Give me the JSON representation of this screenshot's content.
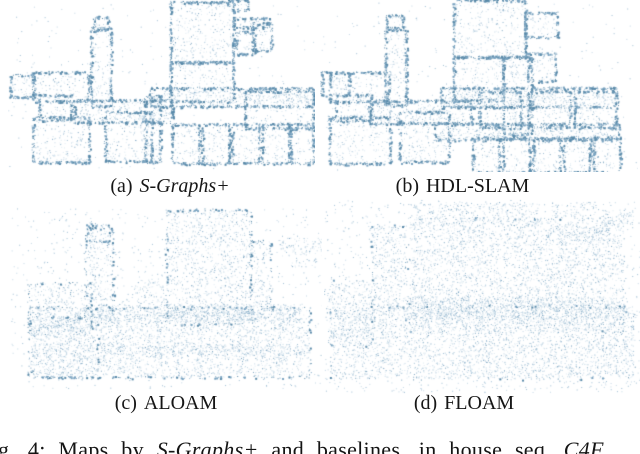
{
  "figure": {
    "panels": [
      {
        "id": "a",
        "label": "(a)",
        "method": "S-Graphs+",
        "method_italic": true,
        "box": {
          "left": 8,
          "top": 0,
          "width": 307,
          "height": 172
        },
        "caption_box": {
          "left": 10,
          "top": 174,
          "width": 320
        },
        "style": {
          "fill": 0.07,
          "edge": 1.0,
          "scatter": 0.004,
          "seed": 101
        },
        "shapes": [
          {
            "x": 0.528,
            "y": 0.012,
            "w": 0.205,
            "h": 0.35,
            "e": 1.1
          },
          {
            "x": 0.733,
            "y": 0.105,
            "w": 0.114,
            "h": 0.052,
            "e": 1
          },
          {
            "x": 0.743,
            "y": 0.186,
            "w": 0.059,
            "h": 0.128,
            "e": 1
          },
          {
            "x": 0.795,
            "y": 0.134,
            "w": 0.062,
            "h": 0.157,
            "e": 1
          },
          {
            "x": 0.717,
            "y": 0.0,
            "w": 0.065,
            "h": 0.058,
            "e": 1
          },
          {
            "x": 0.27,
            "y": 0.163,
            "w": 0.065,
            "h": 0.453,
            "e": 1
          },
          {
            "x": 0.28,
            "y": 0.099,
            "w": 0.046,
            "h": 0.076,
            "e": 1
          },
          {
            "x": 0.007,
            "y": 0.436,
            "w": 0.078,
            "h": 0.128,
            "e": 1
          },
          {
            "x": 0.081,
            "y": 0.419,
            "w": 0.179,
            "h": 0.169,
            "e": 1
          },
          {
            "x": 0.101,
            "y": 0.552,
            "w": 0.104,
            "h": 0.145,
            "e": 1
          },
          {
            "x": 0.081,
            "y": 0.68,
            "w": 0.182,
            "h": 0.262,
            "e": 1
          },
          {
            "x": 0.215,
            "y": 0.581,
            "w": 0.319,
            "h": 0.128,
            "e": 1,
            "f": 1.6
          },
          {
            "x": 0.316,
            "y": 0.651,
            "w": 0.15,
            "h": 0.285,
            "e": 1
          },
          {
            "x": 0.528,
            "y": 0.36,
            "w": 0.205,
            "h": 0.227,
            "e": 1
          },
          {
            "x": 0.463,
            "y": 0.512,
            "w": 0.531,
            "h": 0.105,
            "e": 1,
            "f": 1.8
          },
          {
            "x": 0.772,
            "y": 0.529,
            "w": 0.222,
            "h": 0.215,
            "e": 1
          },
          {
            "x": 0.446,
            "y": 0.558,
            "w": 0.049,
            "h": 0.384,
            "e": 1,
            "f": 1.2
          },
          {
            "x": 0.534,
            "y": 0.721,
            "w": 0.088,
            "h": 0.227,
            "e": 1
          },
          {
            "x": 0.632,
            "y": 0.721,
            "w": 0.088,
            "h": 0.227,
            "e": 1
          },
          {
            "x": 0.73,
            "y": 0.721,
            "w": 0.088,
            "h": 0.227,
            "e": 1
          },
          {
            "x": 0.827,
            "y": 0.721,
            "w": 0.088,
            "h": 0.227,
            "e": 1
          },
          {
            "x": 0.921,
            "y": 0.721,
            "w": 0.073,
            "h": 0.227,
            "e": 1
          }
        ]
      },
      {
        "id": "b",
        "label": "(b)",
        "method": "HDL-SLAM",
        "method_italic": false,
        "box": {
          "left": 320,
          "top": 0,
          "width": 318,
          "height": 172
        },
        "caption_box": {
          "left": 320,
          "top": 174,
          "width": 285
        },
        "style": {
          "fill": 0.07,
          "edge": 1.0,
          "scatter": 0.004,
          "seed": 202
        },
        "shapes": [
          {
            "x": 0.42,
            "y": 0.0,
            "w": 0.225,
            "h": 0.33,
            "e": 1.1
          },
          {
            "x": 0.645,
            "y": 0.075,
            "w": 0.1,
            "h": 0.14,
            "e": 1
          },
          {
            "x": 0.655,
            "y": 0.31,
            "w": 0.085,
            "h": 0.16,
            "e": 1
          },
          {
            "x": 0.575,
            "y": 0.33,
            "w": 0.09,
            "h": 0.45,
            "e": 1,
            "f": 1.3
          },
          {
            "x": 0.205,
            "y": 0.16,
            "w": 0.065,
            "h": 0.45,
            "e": 1
          },
          {
            "x": 0.21,
            "y": 0.09,
            "w": 0.05,
            "h": 0.08,
            "e": 1
          },
          {
            "x": 0.005,
            "y": 0.42,
            "w": 0.085,
            "h": 0.13,
            "e": 1
          },
          {
            "x": 0.03,
            "y": 0.42,
            "w": 0.185,
            "h": 0.17,
            "e": 1
          },
          {
            "x": 0.05,
            "y": 0.55,
            "w": 0.11,
            "h": 0.15,
            "e": 1
          },
          {
            "x": 0.03,
            "y": 0.68,
            "w": 0.19,
            "h": 0.27,
            "e": 1
          },
          {
            "x": 0.155,
            "y": 0.585,
            "w": 0.32,
            "h": 0.13,
            "e": 1,
            "f": 1.6
          },
          {
            "x": 0.25,
            "y": 0.65,
            "w": 0.155,
            "h": 0.29,
            "e": 1
          },
          {
            "x": 0.42,
            "y": 0.33,
            "w": 0.155,
            "h": 0.25,
            "e": 1
          },
          {
            "x": 0.38,
            "y": 0.51,
            "w": 0.555,
            "h": 0.11,
            "e": 1,
            "f": 1.7
          },
          {
            "x": 0.5,
            "y": 0.53,
            "w": 0.13,
            "h": 0.21,
            "e": 1
          },
          {
            "x": 0.655,
            "y": 0.53,
            "w": 0.13,
            "h": 0.21,
            "e": 1
          },
          {
            "x": 0.8,
            "y": 0.53,
            "w": 0.13,
            "h": 0.21,
            "e": 1
          },
          {
            "x": 0.36,
            "y": 0.72,
            "w": 0.58,
            "h": 0.09,
            "e": 1,
            "f": 1.9
          },
          {
            "x": 0.48,
            "y": 0.8,
            "w": 0.083,
            "h": 0.2,
            "e": 1
          },
          {
            "x": 0.575,
            "y": 0.8,
            "w": 0.083,
            "h": 0.2,
            "e": 1
          },
          {
            "x": 0.67,
            "y": 0.8,
            "w": 0.083,
            "h": 0.2,
            "e": 1
          },
          {
            "x": 0.765,
            "y": 0.8,
            "w": 0.083,
            "h": 0.2,
            "e": 1
          },
          {
            "x": 0.86,
            "y": 0.8,
            "w": 0.083,
            "h": 0.2,
            "e": 1
          }
        ]
      },
      {
        "id": "c",
        "label": "(c)",
        "method": "ALOAM",
        "method_italic": false,
        "box": {
          "left": 10,
          "top": 206,
          "width": 312,
          "height": 184
        },
        "caption_box": {
          "left": 10,
          "top": 391,
          "width": 312
        },
        "style": {
          "fill": 0.1,
          "edge": 0.55,
          "scatter": 0.013,
          "seed": 303
        },
        "shapes": [
          {
            "x": 0.245,
            "y": 0.1,
            "w": 0.075,
            "h": 0.09,
            "e": 0.7
          },
          {
            "x": 0.24,
            "y": 0.12,
            "w": 0.09,
            "h": 0.5,
            "e": 0.5
          },
          {
            "x": 0.5,
            "y": 0.02,
            "w": 0.27,
            "h": 0.62,
            "e": 0.5
          },
          {
            "x": 0.77,
            "y": 0.19,
            "w": 0.065,
            "h": 0.42,
            "e": 0.4
          },
          {
            "x": 0.86,
            "y": 0.17,
            "w": 0.15,
            "h": 0.1,
            "e": 0
          },
          {
            "x": 0.9,
            "y": 0.28,
            "w": 0.08,
            "h": 0.05,
            "e": 0
          },
          {
            "x": 0.06,
            "y": 0.42,
            "w": 0.2,
            "h": 0.28,
            "e": 0.5
          },
          {
            "x": 0.07,
            "y": 0.6,
            "w": 0.21,
            "h": 0.33,
            "e": 0.4
          },
          {
            "x": 0.06,
            "y": 0.55,
            "w": 0.9,
            "h": 0.38,
            "e": 0.5,
            "f": 1.1
          },
          {
            "x": 0.28,
            "y": 0.53,
            "w": 0.65,
            "h": 0.1,
            "e": 0,
            "f": 1.8
          },
          {
            "x": 0.4,
            "y": 0.4,
            "w": 0.1,
            "h": 0.13,
            "e": 0
          },
          {
            "x": 0.3,
            "y": 0.75,
            "w": 0.66,
            "h": 0.06,
            "e": 0,
            "f": 1.6
          },
          {
            "x": 0.34,
            "y": 0.56,
            "w": 0.015,
            "h": 0.36,
            "e": 0,
            "f": 1.5
          },
          {
            "x": 0.47,
            "y": 0.56,
            "w": 0.015,
            "h": 0.36,
            "e": 0,
            "f": 1.5
          },
          {
            "x": 0.6,
            "y": 0.56,
            "w": 0.015,
            "h": 0.36,
            "e": 0,
            "f": 1.5
          },
          {
            "x": 0.73,
            "y": 0.56,
            "w": 0.015,
            "h": 0.36,
            "e": 0,
            "f": 1.5
          },
          {
            "x": 0.86,
            "y": 0.56,
            "w": 0.015,
            "h": 0.36,
            "e": 0,
            "f": 1.5
          }
        ]
      },
      {
        "id": "d",
        "label": "(d)",
        "method": "FLOAM",
        "method_italic": false,
        "box": {
          "left": 324,
          "top": 198,
          "width": 316,
          "height": 196
        },
        "caption_box": {
          "left": 324,
          "top": 391,
          "width": 280
        },
        "style": {
          "fill": 0.11,
          "edge": 0.3,
          "scatter": 0.024,
          "seed": 404
        },
        "shapes": [
          {
            "x": 0.28,
            "y": 0.02,
            "w": 0.4,
            "h": 0.12,
            "e": 0
          },
          {
            "x": 0.72,
            "y": 0.02,
            "w": 0.14,
            "h": 0.08,
            "e": 0
          },
          {
            "x": 0.88,
            "y": 0.06,
            "w": 0.1,
            "h": 0.09,
            "e": 0
          },
          {
            "x": 0.7,
            "y": 0.14,
            "w": 0.2,
            "h": 0.1,
            "e": 0
          },
          {
            "x": 0.15,
            "y": 0.14,
            "w": 0.11,
            "h": 0.48,
            "e": 0.3
          },
          {
            "x": 0.27,
            "y": 0.1,
            "w": 0.68,
            "h": 0.58,
            "e": 0.15
          },
          {
            "x": 0.01,
            "y": 0.42,
            "w": 0.14,
            "h": 0.33,
            "e": 0.2
          },
          {
            "x": 0.02,
            "y": 0.55,
            "w": 0.96,
            "h": 0.37,
            "e": 0.2,
            "f": 1.1
          },
          {
            "x": 0.25,
            "y": 0.5,
            "w": 0.7,
            "h": 0.12,
            "e": 0,
            "f": 1.5
          }
        ]
      }
    ],
    "caption": {
      "segments": [
        {
          "text": "g. 4: Maps by ",
          "italic": false
        },
        {
          "text": "S-Graphs+",
          "italic": true
        },
        {
          "text": " and baselines, in house seq. ",
          "italic": false
        },
        {
          "text": "C4F",
          "italic": true
        }
      ]
    }
  },
  "colors": {
    "background": "#ffffff",
    "text": "#161616",
    "cloud_palette": [
      "#dde9f1",
      "#c2d6e4",
      "#9dbdd3",
      "#7aa3c0"
    ],
    "cloud_edge": [
      "#7ba4c1",
      "#5a8aa9"
    ]
  }
}
